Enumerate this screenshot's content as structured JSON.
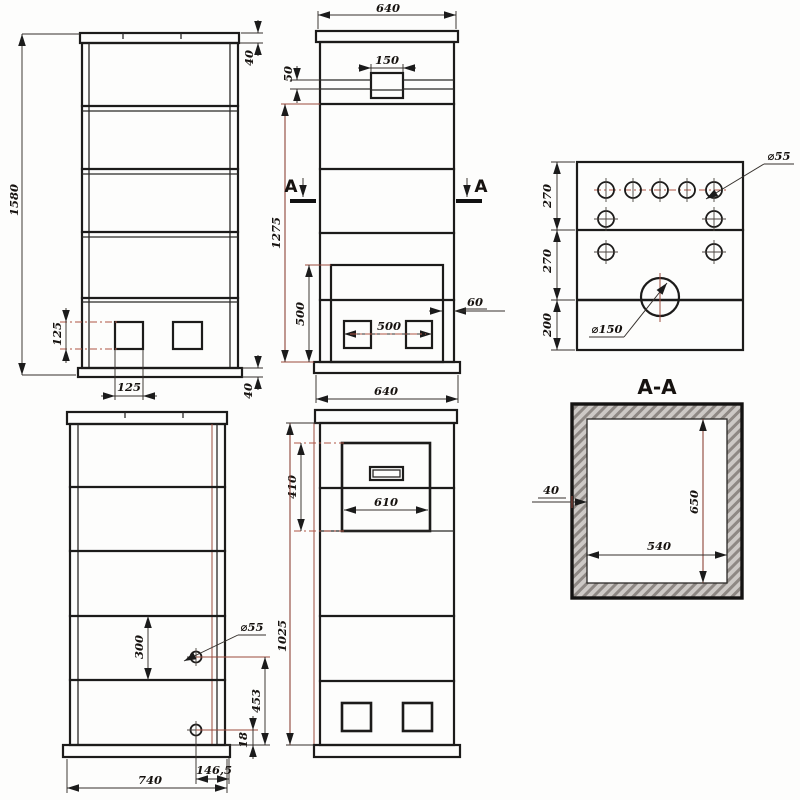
{
  "front_view": {
    "total_height": "1580",
    "cap_height": "40",
    "opening_height": "125",
    "opening_width": "125",
    "base_height": "40"
  },
  "side_view": {
    "top_width": "640",
    "valve_width": "150",
    "valve_offset": "50",
    "shaft_height": "1275",
    "section_label": "A",
    "firebox_height": "500",
    "vent_spacing": "500",
    "edge_gap": "60",
    "bottom_width": "640"
  },
  "plan_view": {
    "row_top": "270",
    "row_mid": "270",
    "row_bottom": "200",
    "hole_diameter": "⌀55",
    "flue_diameter": "⌀150"
  },
  "section_view": {
    "title": "A-A",
    "wall_thickness": "40",
    "inner_height": "650",
    "inner_width": "540"
  },
  "back_view": {
    "band_spacing": "300",
    "hole_diameter": "⌀55",
    "hole_height": "453",
    "hole_bottom_offset": "18",
    "hole_side_offset": "146,5",
    "base_width": "740"
  },
  "lower_front_view": {
    "door_zone_height": "410",
    "body_height": "1025",
    "door_width": "610"
  }
}
